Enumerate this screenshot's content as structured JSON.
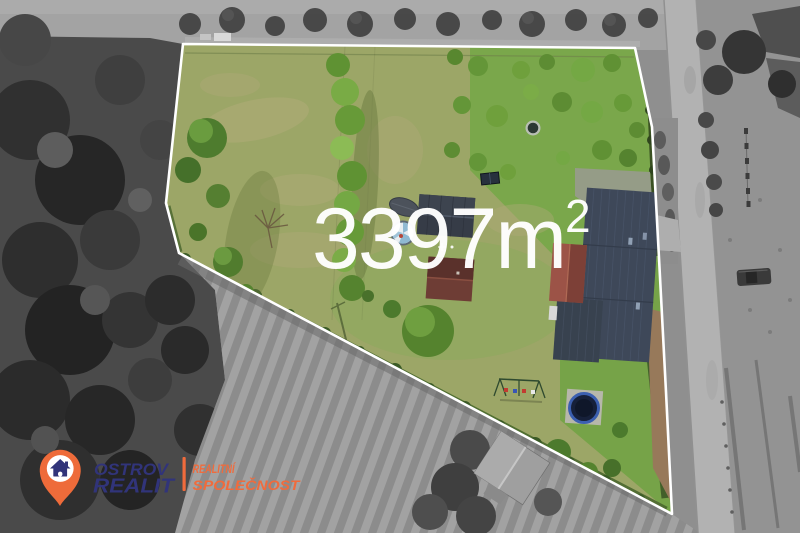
{
  "area_overlay": {
    "value": "3397m",
    "superscript": "2",
    "full_text": "3397m²",
    "color": "#ffffff"
  },
  "logo": {
    "brand_line1": "OSTROV",
    "brand_line2": "REALIT",
    "tagline_line1": "REALITNÍ",
    "tagline_line2": "SPOLEČNOST",
    "pin_icon": "house-location-pin-icon",
    "colors": {
      "navy": "#31347a",
      "orange": "#f06b3c",
      "pin": "#ee6b3a"
    }
  },
  "scene": {
    "type": "aerial-drone-photo-real-estate",
    "boundary_color": "#ffffff",
    "visible_objects": [
      "property-lawn",
      "main-house-dark-roof",
      "red-roof-annex",
      "dark-garage",
      "red-brown-cottage",
      "covered-boat",
      "round-pool",
      "garden-pond",
      "trampoline",
      "swing-set",
      "solar-panel",
      "tree-row",
      "asphalt-road",
      "plowed-field",
      "forest",
      "neighbor-shed"
    ],
    "colors": {
      "lawn_dry": "#9ca667",
      "lawn_vivid": "#7aa74b",
      "tree_green": "#5f9233",
      "house_roof": "#3e4859",
      "annex_roof": "#9c5347",
      "road_gray": "#b2b2b2",
      "field_gray": "#9e9e9e",
      "forest_gray": "#3a3a3a"
    }
  }
}
